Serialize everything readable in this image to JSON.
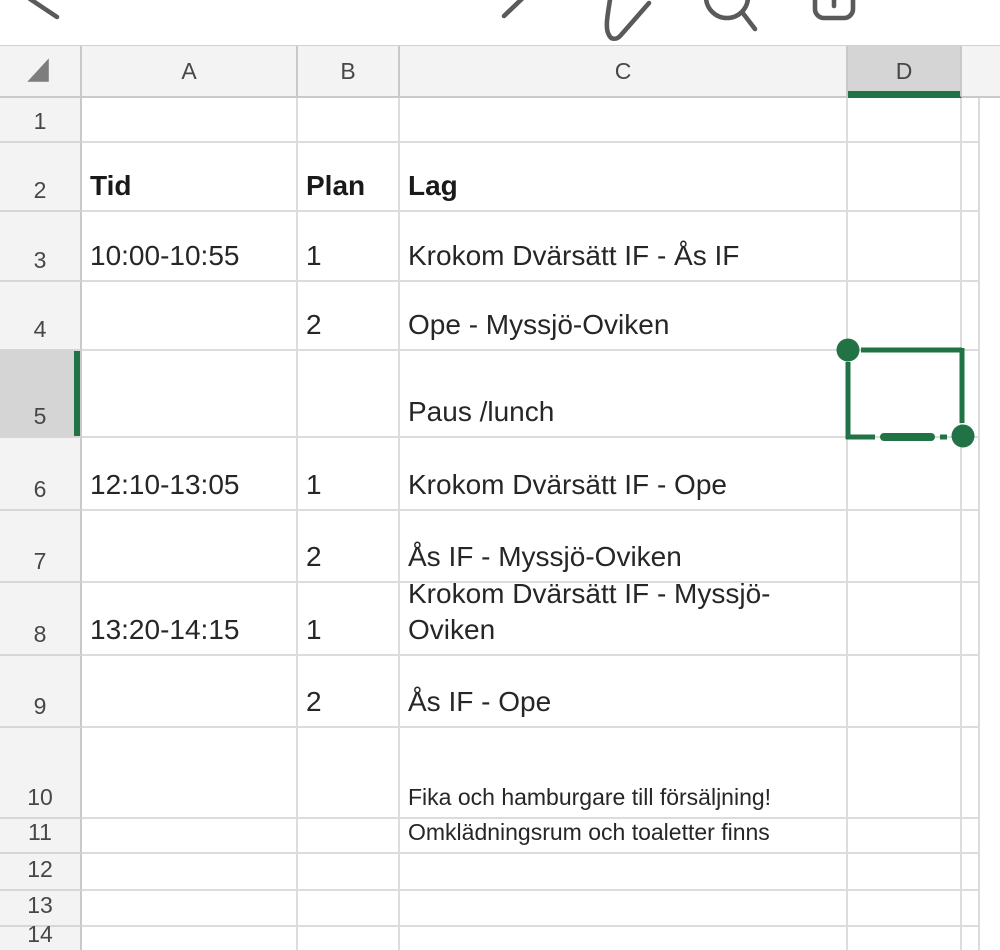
{
  "toolbar": {
    "icons": [
      {
        "name": "back"
      },
      {
        "name": "redo"
      },
      {
        "name": "edit-pen"
      },
      {
        "name": "search"
      },
      {
        "name": "share"
      }
    ]
  },
  "grid": {
    "columns": [
      {
        "label": "A"
      },
      {
        "label": "B"
      },
      {
        "label": "C"
      },
      {
        "label": "D",
        "selected": true
      },
      {
        "label": "",
        "sliver": true
      }
    ],
    "rows": [
      {
        "num": "1",
        "a": "",
        "b": "",
        "c": ""
      },
      {
        "num": "2",
        "a": "Tid",
        "b": "Plan",
        "c": "Lag",
        "bold": true
      },
      {
        "num": "3",
        "a": "10:00-10:55",
        "b": "1",
        "c": "Krokom Dvärsätt IF - Ås IF"
      },
      {
        "num": "4",
        "a": "",
        "b": "2",
        "c": "Ope - Myssjö-Oviken"
      },
      {
        "num": "5",
        "a": "",
        "b": "",
        "c": "Paus /lunch",
        "selected": true
      },
      {
        "num": "6",
        "a": "12:10-13:05",
        "b": "1",
        "c": "Krokom Dvärsätt IF - Ope"
      },
      {
        "num": "7",
        "a": "",
        "b": "2",
        "c": "Ås IF - Myssjö-Oviken"
      },
      {
        "num": "8",
        "a": "13:20-14:15",
        "b": "1",
        "c": "Krokom Dvärsätt IF - Myssjö-Oviken"
      },
      {
        "num": "9",
        "a": "",
        "b": "2",
        "c": "Ås IF - Ope"
      },
      {
        "num": "10",
        "a": "",
        "b": "",
        "c": "Fika och hamburgare till försäljning!",
        "small": true
      },
      {
        "num": "11",
        "a": "",
        "b": "",
        "c": "Omklädningsrum och toaletter finns",
        "small": true
      },
      {
        "num": "12",
        "a": "",
        "b": "",
        "c": ""
      },
      {
        "num": "13",
        "a": "",
        "b": "",
        "c": ""
      },
      {
        "num": "14",
        "a": "",
        "b": "",
        "c": ""
      }
    ]
  },
  "selection": {
    "selected_cell": "D5",
    "selected_column": "D",
    "selected_row": "5"
  },
  "colors": {
    "accent_green": "#217346",
    "header_bg": "#f3f3f3",
    "selected_header_bg": "#d5d5d5",
    "gridline": "#dcdcdc",
    "header_border": "#c9c9c9",
    "cell_text": "#262626",
    "icon_gray": "#5a5a5a"
  }
}
